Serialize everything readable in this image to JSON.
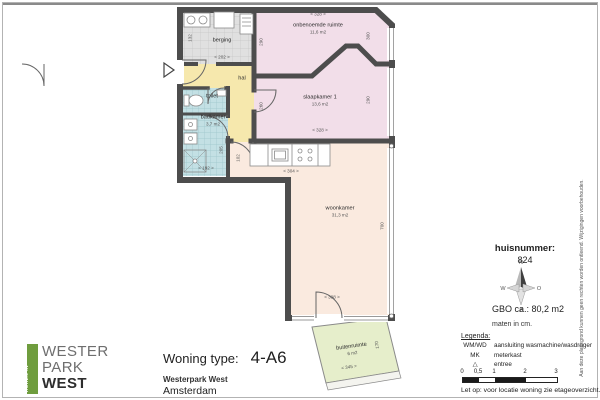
{
  "plan": {
    "rooms": {
      "berging": {
        "name": "berging"
      },
      "onbenoemde": {
        "name": "onbenoemde ruimte",
        "area": "11,6 m2"
      },
      "slaapkamer": {
        "name": "slaapkamer 1",
        "area": "13,6 m2"
      },
      "hal": {
        "name": "hal"
      },
      "toilet": {
        "name": "toilet"
      },
      "badkamer": {
        "name": "badkamer",
        "area": "3,7 m2"
      },
      "woonkamer": {
        "name": "woonkamer",
        "area": "31,3 m2"
      },
      "buitenruimte": {
        "name": "buitenruimte",
        "area": "6 m2"
      }
    },
    "dims": {
      "onbenoemde_top": "< 328 >",
      "onbenoemde_left": "290",
      "onbenoemde_right": "300",
      "slaapkamer_bottom": "< 328 >",
      "slaapkamer_left": "260",
      "slaapkamer_right": "290",
      "berging_width": "< 202 >",
      "berging_side": "132",
      "badkamer_width": "< 192 >",
      "badkamer_side": "205",
      "kitchen_width": "< 304 >",
      "kitchen_side": "102",
      "woonkamer_side": "700",
      "woonkamer_bottom": "< 398 >",
      "buitenruimte_width": "< 345 >",
      "buitenruimte_side": "170"
    },
    "colors": {
      "wall": "#4d4d4d",
      "bedroom_pink": "#f2dee9",
      "hal_yellow": "#f6e8ad",
      "wet_teal": "#c3e0e4",
      "living_peach": "#faeadf",
      "outdoor_green": "#e6eecb",
      "storage_gray": "#e0e0e0"
    }
  },
  "info_panel": {
    "huisnummer_label": "huisnummer:",
    "huisnummer": "824",
    "compass": {
      "n": "N",
      "o": "O",
      "z": "Z",
      "w": "W"
    },
    "gbo": "GBO ca.:  80,2 m2",
    "units": "maten in cm.",
    "legend": {
      "title": "Legenda:",
      "rows": [
        {
          "key": "WM/WD",
          "value": "aansluiting wasmachine/wasdroger"
        },
        {
          "key": "MK",
          "value": "meterkast"
        },
        {
          "key": "△",
          "value": "entree"
        }
      ]
    },
    "scalebar": {
      "labels": [
        "0",
        "0,5",
        "1",
        "2",
        "3"
      ]
    },
    "note": "Let op:  voor locatie woning zie etageoverzicht."
  },
  "title_block": {
    "type_label": "Woning type:",
    "type_value": "4-A6",
    "project": "Westerpark West",
    "city": "Amsterdam"
  },
  "logo": {
    "vertical": "HUREN IN",
    "line1": "WESTER",
    "line2": "PARK",
    "line3": "WEST",
    "green": "#6f9d3e"
  },
  "disclaimer": "Aan deze plattegrond kunnen geen rechten worden ontleend. Wijzigingen voorbehouden."
}
